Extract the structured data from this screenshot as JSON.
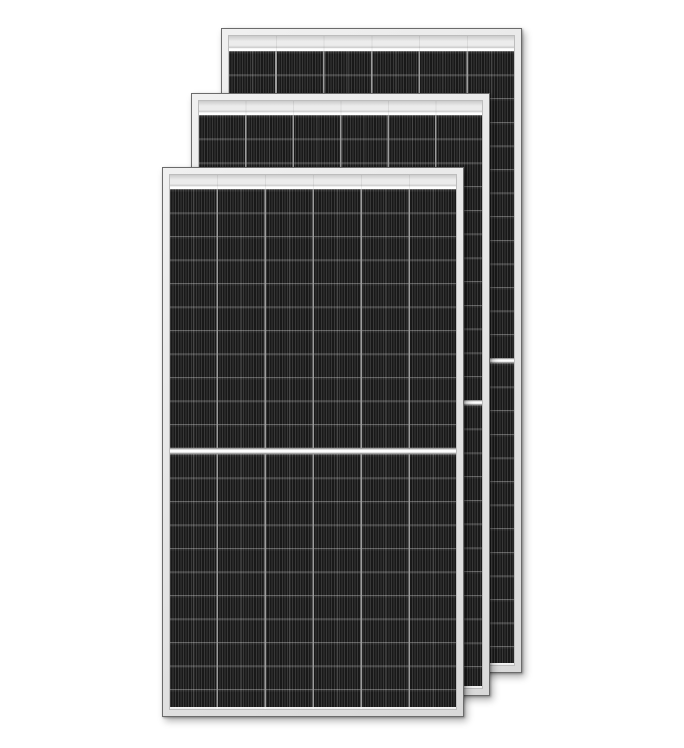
{
  "scene": {
    "type": "product-image",
    "subject": "Three overlapping framed half-cut monocrystalline solar panels, portrait orientation, on a plain white background",
    "panel_count": 3,
    "text_content": "none"
  },
  "colors": {
    "background": "#ffffff",
    "frame_face": "#f0f0f0",
    "frame_face_dark": "#d9d9d9",
    "frame_outline": "#6b6b6b",
    "frame_inner_line": "#bdbdbd",
    "top_band_light": "#ececec",
    "top_band_shade": "#cccccc",
    "band_highlight": "#ffffff",
    "cell_base": "#232323",
    "cell_stripe_dark": "#191919",
    "cell_stripe_light": "#383838",
    "column_line": "#9d9d9d",
    "mid_column_line": "rgba(255,255,255,0.14)",
    "row_line": "rgba(255,255,255,0.30)",
    "divider_white": "#fdfdfd",
    "divider_edge": "#9f9f9f",
    "shadow": "rgba(0,0,0,0.30)"
  },
  "panels": [
    {
      "id": "back",
      "position": "rear, top-right of stack",
      "cell_columns": 6,
      "cell_rows_per_half": 13,
      "halves": 2,
      "center_divider": "horizontal white band",
      "frame": "silver aluminium"
    },
    {
      "id": "middle",
      "position": "middle of stack",
      "cell_columns": 6,
      "cell_rows_per_half": 12,
      "halves": 2,
      "center_divider": "horizontal white band",
      "frame": "silver aluminium"
    },
    {
      "id": "front",
      "position": "front, bottom-left of stack",
      "cell_columns": 6,
      "cell_rows_per_half": 11,
      "halves": 2,
      "center_divider": "horizontal white band",
      "frame": "silver aluminium"
    }
  ]
}
